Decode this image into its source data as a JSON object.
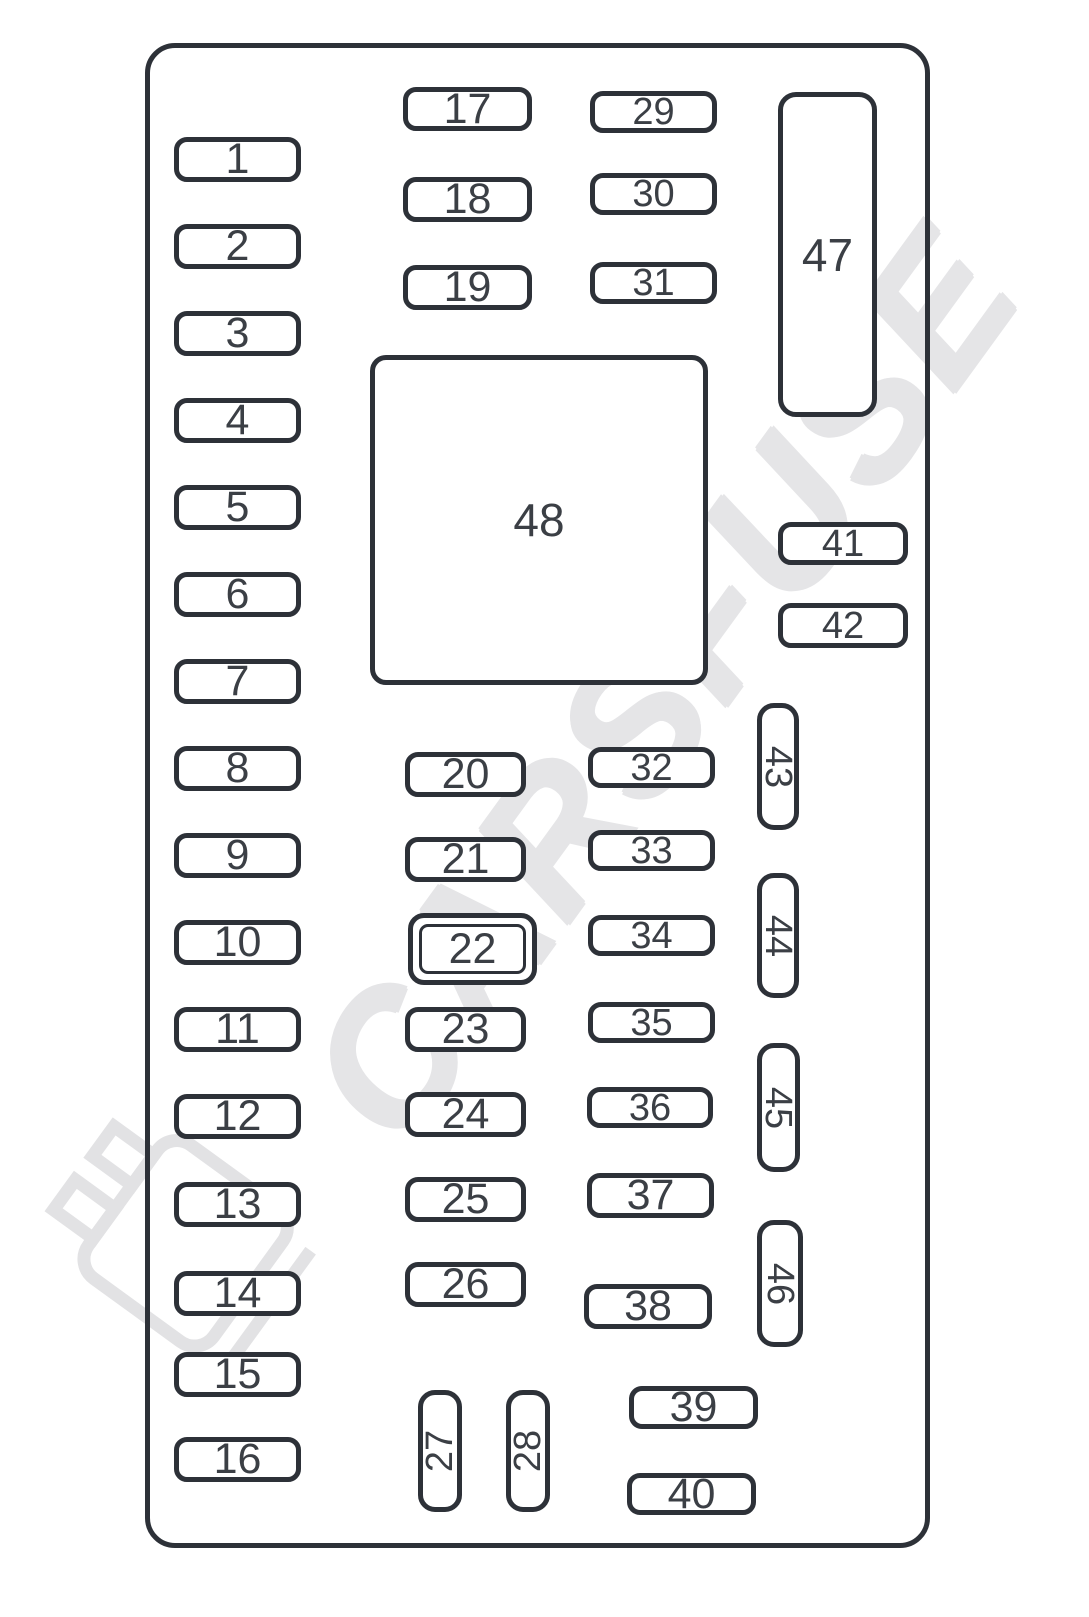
{
  "diagram": {
    "kind": "vehicle fuse box layout diagram",
    "watermark": {
      "text": "CARSFUSE"
    },
    "colors": {
      "outline": "#2d3138",
      "label": "#3b3f45",
      "watermark": "#e5e5e7",
      "background": "#ffffff"
    }
  },
  "watermark": {
    "text": "CARSFUSE"
  },
  "fuses": {
    "left_column": [
      "1",
      "2",
      "3",
      "4",
      "5",
      "6",
      "7",
      "8",
      "9",
      "10",
      "11",
      "12",
      "13",
      "14",
      "15",
      "16"
    ],
    "center_top_left": [
      "17",
      "18",
      "19"
    ],
    "center_mid_left": [
      "20",
      "21",
      "22",
      "23",
      "24",
      "25",
      "26"
    ],
    "bottom_vertical": [
      "27",
      "28"
    ],
    "center_top_right": [
      "29",
      "30",
      "31"
    ],
    "center_mid_right": [
      "32",
      "33",
      "34",
      "35",
      "36",
      "37",
      "38"
    ],
    "bottom_right": [
      "39",
      "40"
    ],
    "right_horizontal": [
      "41",
      "42"
    ],
    "right_vertical": [
      "43",
      "44",
      "45",
      "46"
    ],
    "large_blocks": [
      "47",
      "48"
    ]
  }
}
